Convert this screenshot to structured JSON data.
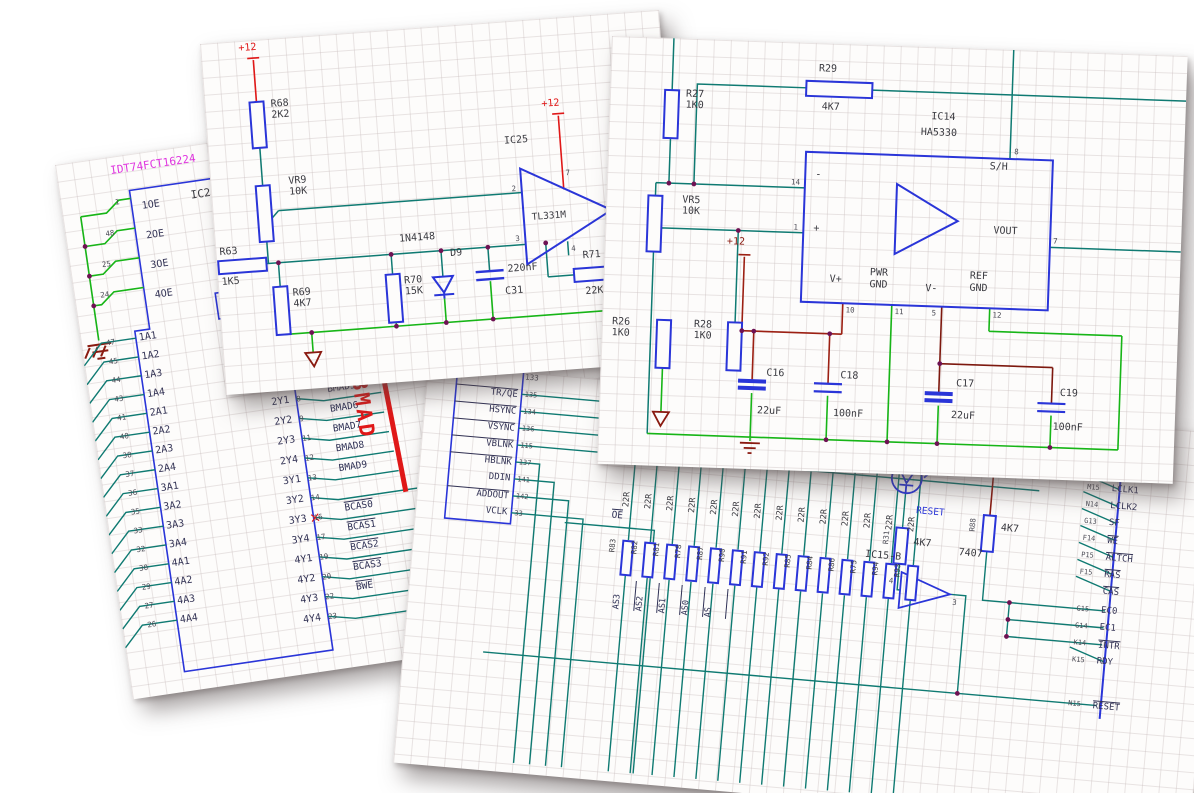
{
  "collage": {
    "description": "Four overlapping electronic schematic sheets"
  },
  "colors": {
    "wire_teal": "#0f7a72",
    "wire_green": "#17b517",
    "wire_red": "#e01818",
    "wire_maroon": "#8a1a10",
    "component_blue": "#2a35d8",
    "junction_purple": "#6e1253",
    "part_magenta": "#df35df",
    "grid": "#cbc0c0"
  },
  "sheet_a": {
    "supply_left": "+12",
    "supply_right": "+12",
    "r68": {
      "ref": "R68",
      "value": "2K2"
    },
    "vr9": {
      "ref": "VR9",
      "value": "10K"
    },
    "ic25": {
      "ref": "IC25",
      "part": "TL331M",
      "pins": {
        "inv": "2",
        "noninv": "3",
        "vcc": "7",
        "out": "6",
        "gnd": "4"
      }
    },
    "r63": {
      "ref": "R63",
      "value": "1K5"
    },
    "r69": {
      "ref": "R69",
      "value": "4K7"
    },
    "r70": {
      "ref": "R70",
      "value": "15K"
    },
    "d9": {
      "part": "1N4148",
      "ref": "D9"
    },
    "c31": {
      "value": "220nF",
      "ref": "C31"
    },
    "r71": {
      "ref": "R71",
      "value": "22K"
    }
  },
  "sheet_b": {
    "supply": "+12",
    "r27": {
      "ref": "R27",
      "value": "1K0"
    },
    "r29": {
      "ref": "R29",
      "value": "4K7"
    },
    "vr5": {
      "ref": "VR5",
      "value": "10K"
    },
    "r26": {
      "ref": "R26",
      "value": "1K0"
    },
    "r28": {
      "ref": "R28",
      "value": "1K0"
    },
    "ic14": {
      "ref": "IC14",
      "part": "HA5330",
      "inv": "-",
      "noninv": "+",
      "sh": "S/H",
      "vout": "VOUT",
      "vplus": "V+",
      "pwrgnd": [
        "PWR",
        "GND"
      ],
      "vminus": "V-",
      "refgnd": [
        "REF",
        "GND"
      ],
      "pins": {
        "inv": "14",
        "noninv": "1",
        "sh": "8",
        "vout": "7",
        "vplus": "10",
        "pwrgnd": "11",
        "vminus": "5",
        "refgnd": "12"
      }
    },
    "c16": {
      "ref": "C16",
      "value": "22uF"
    },
    "c18": {
      "ref": "C18",
      "value": "100nF"
    },
    "c17": {
      "ref": "C17",
      "value": "22uF"
    },
    "c19": {
      "ref": "C19",
      "value": "100nF"
    }
  },
  "sheet_c": {
    "part": "IDT74FCT16224",
    "ref": "IC2",
    "oe_rows": [
      {
        "pin": "1",
        "name": "1OE"
      },
      {
        "pin": "48",
        "name": "2OE"
      },
      {
        "pin": "25",
        "name": "3OE"
      },
      {
        "pin": "24",
        "name": "4OE"
      }
    ],
    "in_rows": [
      {
        "pin": "47",
        "name": "1A1"
      },
      {
        "pin": "45",
        "name": "1A2"
      },
      {
        "pin": "44",
        "name": "1A3"
      },
      {
        "pin": "43",
        "name": "1A4"
      },
      {
        "pin": "41",
        "name": "2A1"
      },
      {
        "pin": "40",
        "name": "2A2"
      },
      {
        "pin": "38",
        "name": "2A3"
      },
      {
        "pin": "37",
        "name": "2A4"
      },
      {
        "pin": "36",
        "name": "3A1"
      },
      {
        "pin": "35",
        "name": "3A2"
      },
      {
        "pin": "33",
        "name": "3A3"
      },
      {
        "pin": "32",
        "name": "3A4"
      },
      {
        "pin": "30",
        "name": "4A1"
      },
      {
        "pin": "29",
        "name": "4A2"
      },
      {
        "pin": "27",
        "name": "4A3"
      },
      {
        "pin": "26",
        "name": "4A4"
      }
    ],
    "out_rows": [
      {
        "name": "2Y1",
        "pin": "8",
        "net": "BMAD5",
        "overline": false
      },
      {
        "name": "2Y2",
        "pin": "9",
        "net": "BMAD6",
        "overline": false
      },
      {
        "name": "2Y3",
        "pin": "11",
        "net": "BMAD7",
        "overline": false
      },
      {
        "name": "2Y4",
        "pin": "12",
        "net": "BMAD8",
        "overline": false
      },
      {
        "name": "3Y1",
        "pin": "13",
        "net": "BMAD9",
        "overline": false
      },
      {
        "name": "3Y2",
        "pin": "14",
        "net": "",
        "overline": false
      },
      {
        "name": "3Y3",
        "pin": "16",
        "net": "BCAS0",
        "overline": true
      },
      {
        "name": "3Y4",
        "pin": "17",
        "net": "BCAS1",
        "overline": true
      },
      {
        "name": "4Y1",
        "pin": "19",
        "net": "BCAS2",
        "overline": true
      },
      {
        "name": "4Y2",
        "pin": "20",
        "net": "BCAS3",
        "overline": true
      },
      {
        "name": "4Y3",
        "pin": "22",
        "net": "BWE",
        "overline": true
      },
      {
        "name": "4Y4",
        "pin": "23",
        "net": "",
        "overline": false
      }
    ],
    "bus_label": "BMAD"
  },
  "sheet_d": {
    "hidden_pin": "133",
    "box_rows": [
      {
        "name": "TR/QE",
        "pin": "135",
        "overline": true
      },
      {
        "name": "HSYNC",
        "pin": "134",
        "overline": true
      },
      {
        "name": "VSYNC",
        "pin": "136",
        "overline": true
      },
      {
        "name": "VBLNK",
        "pin": "115",
        "overline": true
      },
      {
        "name": "HBLNK",
        "pin": "137",
        "overline": true
      },
      {
        "name": "DDIN",
        "pin": "141",
        "overline": false
      },
      {
        "name": "ADDOUT",
        "pin": "142",
        "overline": true
      },
      {
        "name": "VCLK",
        "pin": "33",
        "overline": false
      }
    ],
    "oe_net": "OE",
    "resistors": {
      "value": "22R",
      "refs": [
        "R83",
        "R82",
        "R81",
        "R78",
        "R87",
        "R90",
        "R91",
        "R92",
        "R85",
        "R84",
        "R86",
        "R75",
        "R94",
        "R93"
      ]
    },
    "net_stubs": [
      "AS3",
      "AS2",
      "AS1",
      "AS0",
      "AS"
    ],
    "led": {
      "pin": "2",
      "ref": "LED1",
      "net": "RESET"
    },
    "r31": {
      "ref": "R31",
      "value": "4K7"
    },
    "r88": {
      "ref": "R88",
      "value": "4K7"
    },
    "ic15": {
      "ref": "IC15-B",
      "part": "7407",
      "pin_in": "4",
      "pin_out": "3"
    },
    "conn_rows_1": [
      {
        "pin": "M15",
        "name": "LCLK1",
        "overline": false
      },
      {
        "pin": "N14",
        "name": "LCLK2",
        "overline": false
      },
      {
        "pin": "G13",
        "name": "SF",
        "overline": false
      },
      {
        "pin": "F14",
        "name": "WE",
        "overline": true
      },
      {
        "pin": "P15",
        "name": "ALTCH",
        "overline": true
      },
      {
        "pin": "F15",
        "name": "RAS",
        "overline": true
      },
      {
        "pin": "",
        "name": "CAS",
        "overline": true
      }
    ],
    "conn_rows_2": [
      {
        "pin": "G15",
        "name": "EC0",
        "overline": false
      },
      {
        "pin": "G14",
        "name": "EC1",
        "overline": false
      },
      {
        "pin": "K14",
        "name": "INTR",
        "overline": true
      },
      {
        "pin": "K15",
        "name": "RDY",
        "overline": false
      }
    ],
    "conn_rows_3": [
      {
        "pin": "N15",
        "name": "RESET",
        "overline": true
      }
    ]
  }
}
